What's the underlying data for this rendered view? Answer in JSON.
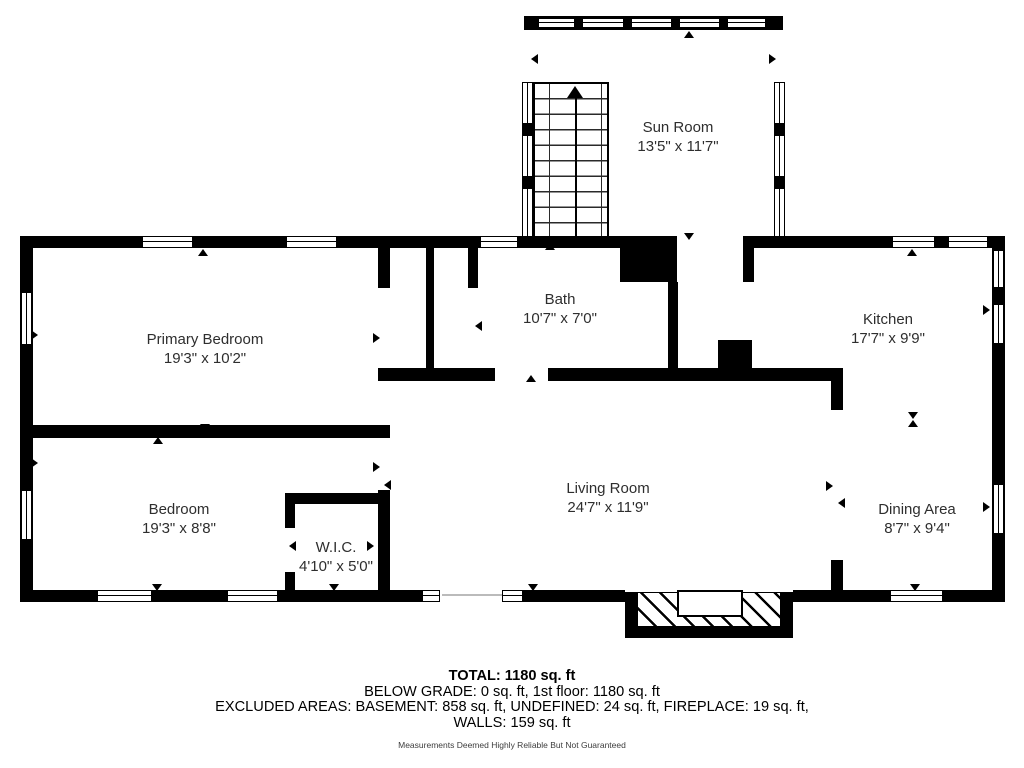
{
  "rooms": {
    "sun_room": {
      "name": "Sun Room",
      "dims": "13'5\" x 11'7\""
    },
    "primary_bedroom": {
      "name": "Primary Bedroom",
      "dims": "19'3\" x 10'2\""
    },
    "bath": {
      "name": "Bath",
      "dims": "10'7\" x 7'0\""
    },
    "kitchen": {
      "name": "Kitchen",
      "dims": "17'7\" x 9'9\""
    },
    "bedroom": {
      "name": "Bedroom",
      "dims": "19'3\" x 8'8\""
    },
    "wic": {
      "name": "W.I.C.",
      "dims": "4'10\" x 5'0\""
    },
    "living_room": {
      "name": "Living Room",
      "dims": "24'7\" x 11'9\""
    },
    "dining_area": {
      "name": "Dining Area",
      "dims": "8'7\" x 9'4\""
    }
  },
  "summary": {
    "total": "TOTAL: 1180 sq. ft",
    "below_grade": "BELOW GRADE: 0 sq. ft, 1st floor: 1180 sq. ft",
    "excluded": "EXCLUDED AREAS: BASEMENT: 858 sq. ft, UNDEFINED: 24 sq. ft, FIREPLACE: 19 sq. ft,",
    "walls": "WALLS: 159 sq. ft",
    "disclaimer": "Measurements Deemed Highly Reliable But Not Guaranteed"
  },
  "colors": {
    "wall": "#000000",
    "background": "#ffffff",
    "label_text": "#2e2e2e"
  }
}
